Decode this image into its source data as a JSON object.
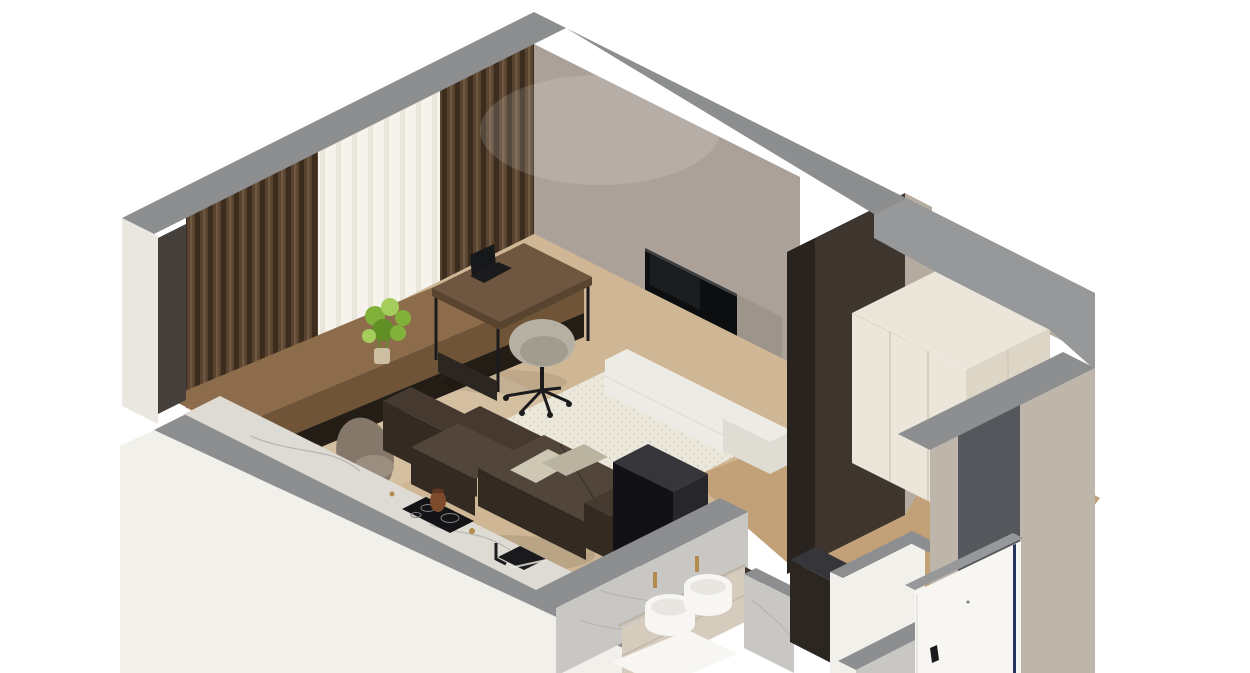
{
  "scene": {
    "description": "Isometric 3D cutaway render of a studio apartment interior (dollhouse view)",
    "rooms": [
      "living-room",
      "kitchen-run",
      "bathroom",
      "entrance-hall",
      "wardrobe-niche"
    ],
    "background": "#ffffff"
  },
  "palette": {
    "bg": "#ffffff",
    "wallBand": "#8d8e90",
    "wallBandLight": "#97989a",
    "extWhite": "#f2f0ea",
    "extCream": "#eae7e0",
    "endCapDark": "#45403b",
    "wallNwBase": "#2a221b",
    "curtain": "#57432f",
    "curtainDark": "#3b2c1e",
    "curtainHi": "#6e5840",
    "sheer": "#f6f3ec",
    "sheerShade": "#dfd9cb",
    "tvWall": "#aba198",
    "tvBlack": "#0d0e10",
    "tvEdge": "#3c4043",
    "floorMain": "#cfb795",
    "floorHall": "#c2a078",
    "rug": "#ebe7db",
    "rugDot": "#d7d2c2",
    "consoleWood": "#8d6c4c",
    "consoleWoodDark": "#6f5438",
    "consoleShadow": "#241d15",
    "deskWood": "#6e5640",
    "deskWoodDark": "#594430",
    "metalBlack": "#1b1b1d",
    "laptopDark": "#17181a",
    "chairTaupe": "#85786a",
    "chairTaupeLight": "#9b8e80",
    "officeSeat": "#b6b0a4",
    "officeSeatDark": "#a29c8f",
    "sofa": "#463a30",
    "sofaLight": "#52453a",
    "sofaDark": "#332a22",
    "pillow": "#cdc7b4",
    "pillowDark": "#b9b3a0",
    "mediaWhite": "#edebe5",
    "mediaWhiteDark": "#dfdcd4",
    "slabDark": "#3e362e",
    "slabDarker": "#2c2620",
    "wallSliver": "#b5aba1",
    "boxBlack": "#121216",
    "boxBlackSide": "#26262b",
    "boxTop": "#36363a",
    "counterMarble": "#dedbd5",
    "marbleVein": "#a5a29b",
    "burnerRing": "#828284",
    "hobBlack": "#141416",
    "kettleCopper": "#7d4b2c",
    "kettleDark": "#5f3720",
    "sinkBlack": "#1a1a1c",
    "binWhite": "#eeeae2",
    "binWhiteDark": "#ddd8cd",
    "bathMarble": "#c9c7c3",
    "bathMarbleDark": "#a9a7a3",
    "vanity": "#d6ccbd",
    "vanityDark": "#bfb5a5",
    "sinkWhite": "#f7f6f3",
    "sinkShade": "#dcd9d2",
    "gold": "#b18c4f",
    "wardrobe": "#ece6da",
    "wardrobeSide": "#ddd5c6",
    "wardrobeShade": "#cfc7b8",
    "doorWhite": "#f7f6f2",
    "doorNavy": "#27335a",
    "doorHinge": "#d9d6d0",
    "doorwayDark": "#54575c",
    "extGreige": "#beb5ab",
    "greenLeaf": "#82b13b",
    "greenLeafDark": "#5f8f25",
    "greenLeafLight": "#a5cd5e",
    "vaseGlass": "#d8cdb2",
    "shadow": "#000000",
    "white": "#ffffff"
  },
  "objects": [
    {
      "name": "window-curtains",
      "label": "Brown floor-to-ceiling curtains with white sheer"
    },
    {
      "name": "bar-console",
      "label": "Long wood console along window with green plant"
    },
    {
      "name": "dining-chairs",
      "label": "Two taupe dining chairs"
    },
    {
      "name": "desk",
      "label": "Dark wood desk with laptop"
    },
    {
      "name": "office-chair",
      "label": "Greige swivel office chair"
    },
    {
      "name": "sofa",
      "label": "Dark brown sectional sofa with sage pillows"
    },
    {
      "name": "tv",
      "label": "Wall-mounted TV above white media console"
    },
    {
      "name": "kitchen-counter",
      "label": "Marble counter with induction hob and black sink"
    },
    {
      "name": "bathroom-vanity",
      "label": "Double round vessel sinks with gold faucets"
    },
    {
      "name": "wardrobe",
      "label": "Cream wardrobe in hallway niche"
    },
    {
      "name": "entrance-door",
      "label": "White entry door, open"
    }
  ]
}
